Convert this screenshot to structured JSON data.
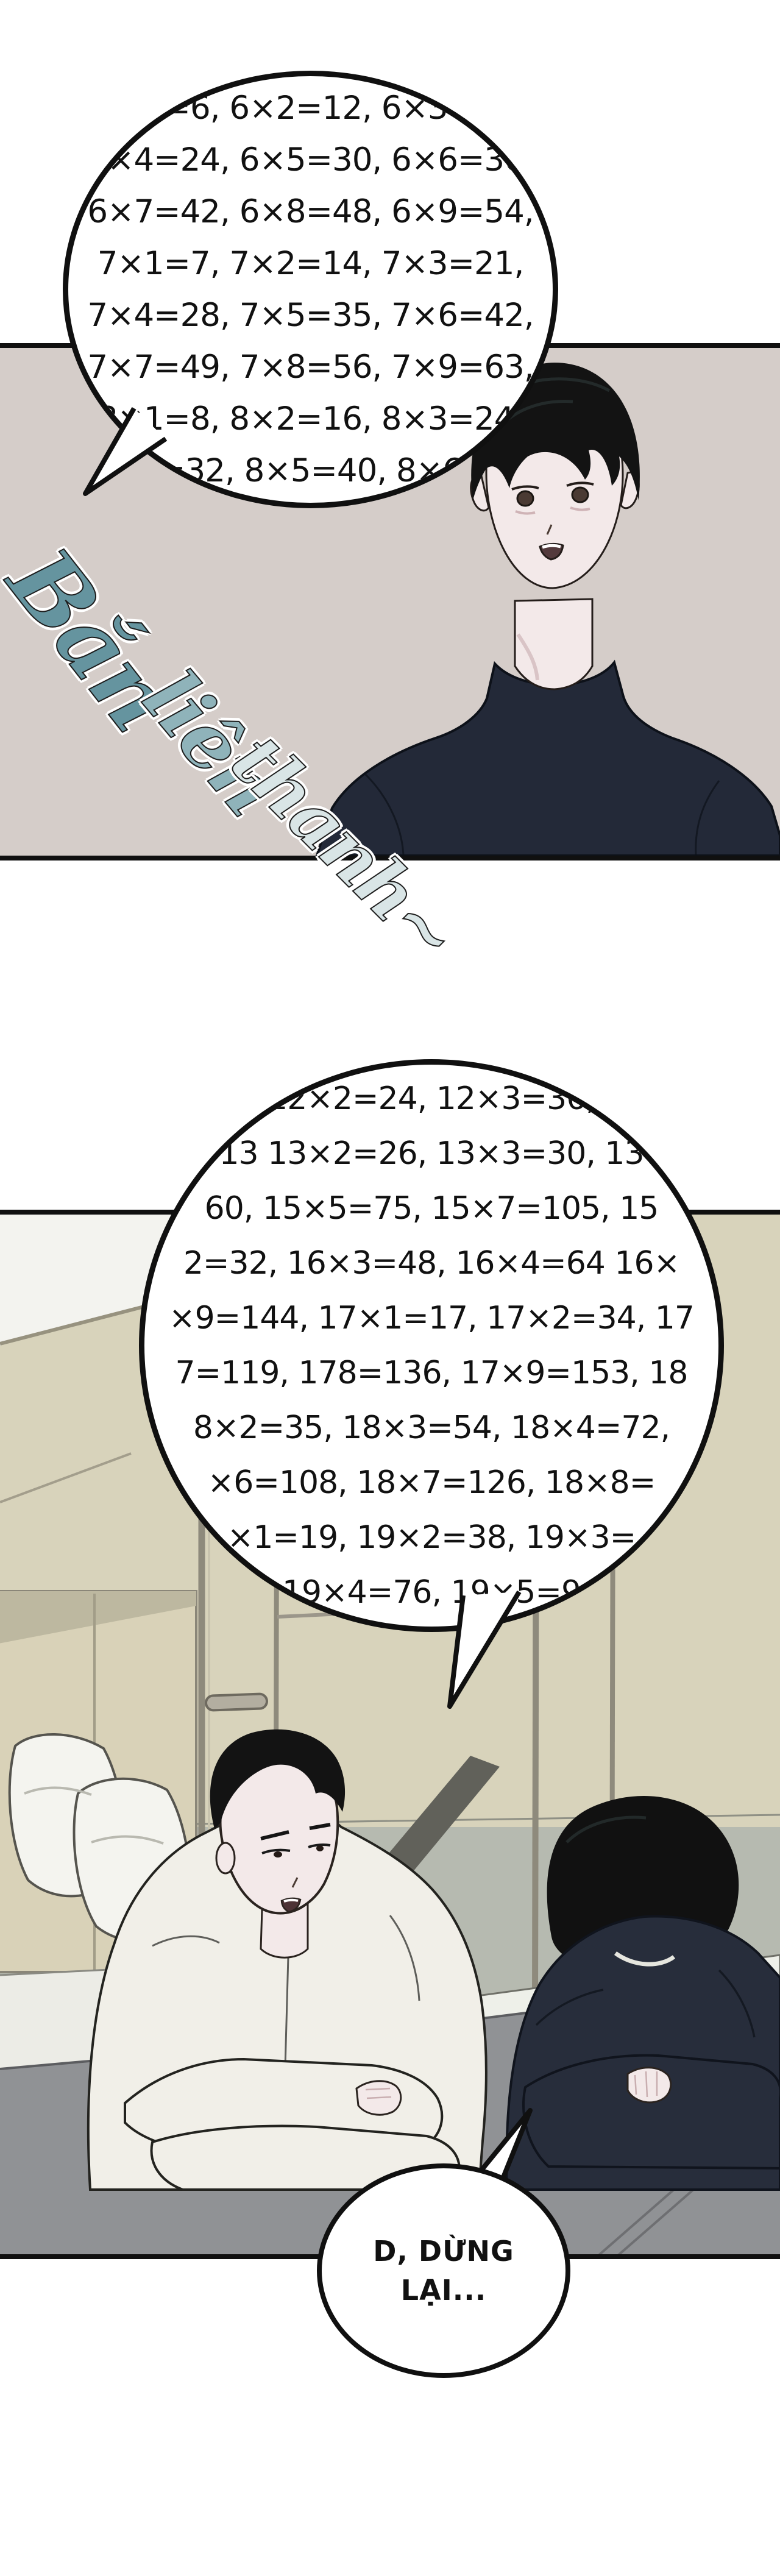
{
  "page": {
    "kind": "webtoon-comic-page",
    "background": "#ffffff"
  },
  "bubble1": {
    "lines": [
      "6×1=6, 6×2=12, 6×3=18,",
      "6×4=24, 6×5=30, 6×6=36,",
      "6×7=42, 6×8=48, 6×9=54,",
      "7×1=7, 7×2=14, 7×3=21,",
      "7×4=28, 7×5=35, 7×6=42,",
      "7×7=49, 7×8=56, 7×9=63,",
      "8×1=8, 8×2=16, 8×3=24,",
      "8×4=32, 8×5=40, 8×6=48"
    ]
  },
  "sfx": {
    "words": [
      "Bắn",
      "liên",
      "thanh~"
    ],
    "colors": [
      "#65949f",
      "#8fb3ba",
      "#d9e5e6"
    ]
  },
  "bubble2": {
    "lines": [
      "12×2=24, 12×3=36,",
      "13 13×2=26, 13×3=30, 13",
      "60, 15×5=75, 15×7=105, 15",
      "2=32, 16×3=48, 16×4=64 16×",
      "×9=144, 17×1=17, 17×2=34, 17",
      "7=119, 178=136, 17×9=153, 18",
      "8×2=35, 18×3=54, 18×4=72,",
      "×6=108, 18×7=126, 18×8=",
      "×1=19, 19×2=38, 19×3=",
      "19×4=76, 19×5=9"
    ]
  },
  "bubble3": {
    "lines": [
      "D, DỪNG",
      "LẠI..."
    ]
  },
  "colors": {
    "panel1_bg": "#d5cdc9",
    "panel2_wall": "#d8d3bb",
    "panel2_lower_wall": "#b6bab0",
    "ceiling": "#f3f3ef",
    "table": "#909295",
    "window_sill": "#eef0e9",
    "bedding": "#ececе6",
    "shirt_white": "#f1efe8",
    "shirt_navy": "#232938",
    "sweater_navy": "#272d3b",
    "skin": "#f3e9e9",
    "hair": "#131313",
    "outline": "#101010"
  }
}
